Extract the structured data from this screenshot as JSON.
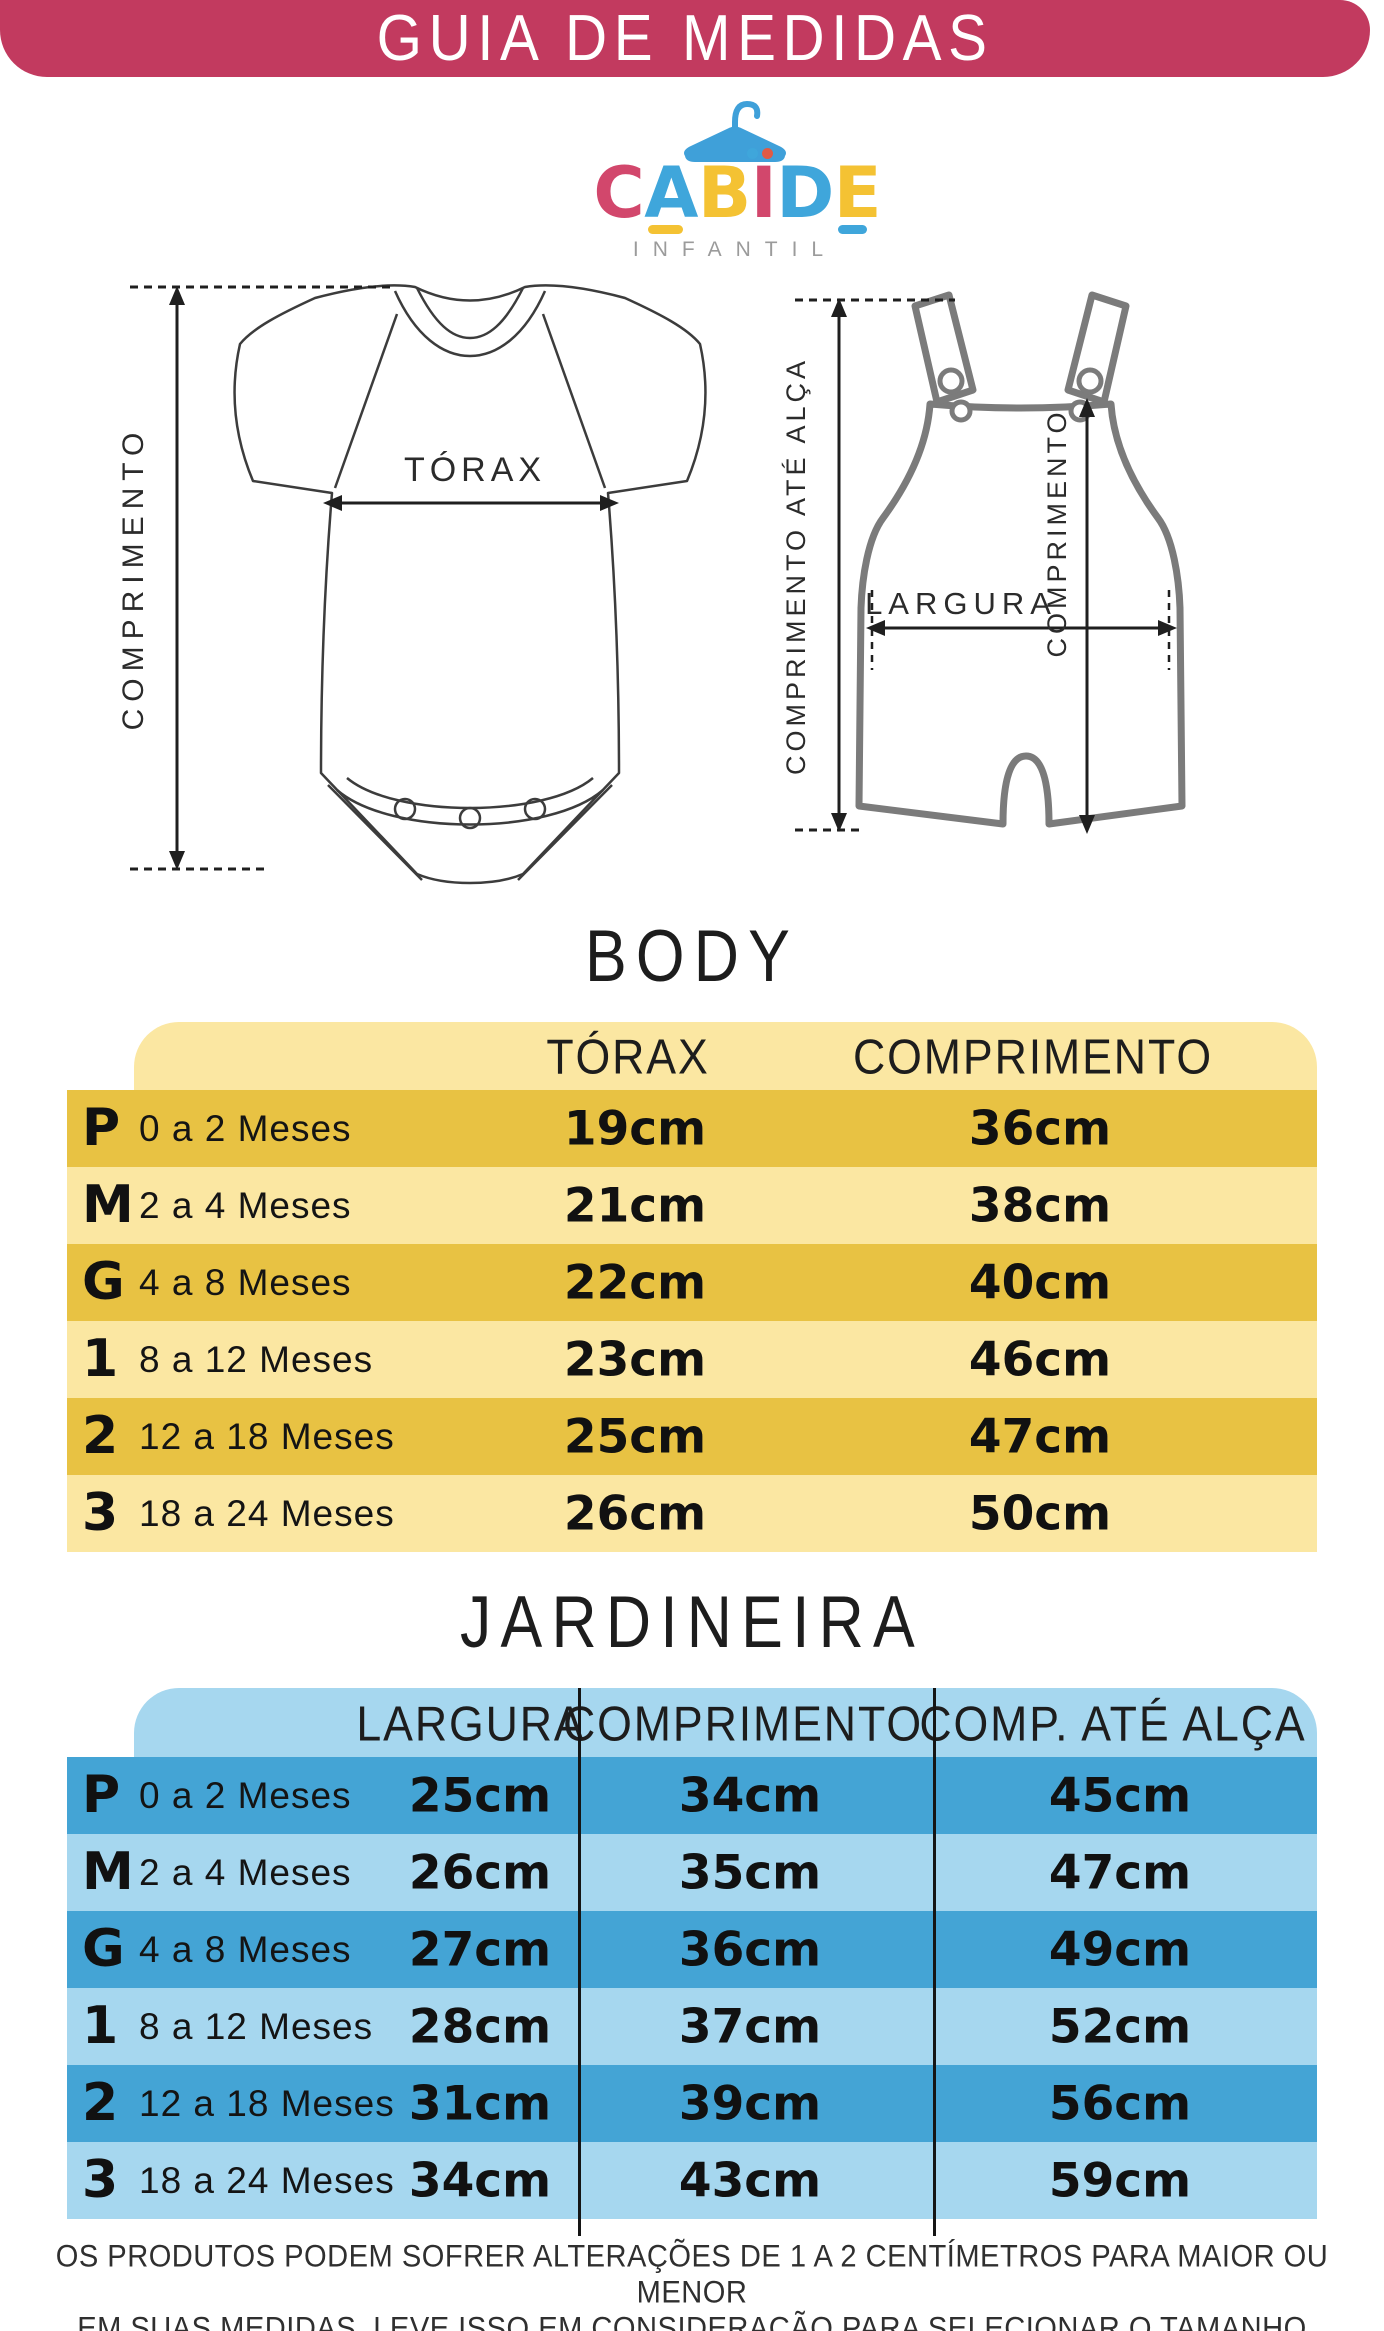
{
  "header": {
    "title": "GUIA DE MEDIDAS",
    "bg_color": "#C23A5F"
  },
  "logo": {
    "letters": [
      {
        "ch": "C",
        "color": "#D2476C"
      },
      {
        "ch": "A",
        "color": "#3FA6DB",
        "underline": "#F4C233"
      },
      {
        "ch": "B",
        "color": "#F4C233"
      },
      {
        "ch": "I",
        "color": "#D2476C",
        "dot_left": "#3FA6DB",
        "dot_right": "#E05A45"
      },
      {
        "ch": "D",
        "color": "#3FA6DB"
      },
      {
        "ch": "E",
        "color": "#F4C233",
        "underline": "#3FA6DB"
      }
    ],
    "subtitle": "INFANTIL",
    "hanger_color": "#3FA0D9"
  },
  "diagrams": {
    "body": {
      "labels": {
        "length": "COMPRIMENTO",
        "chest": "TÓRAX"
      }
    },
    "jardineira": {
      "labels": {
        "strap": "COMPRIMENTO ATÉ ALÇA",
        "length": "COMPRIMENTO",
        "width": "LARGURA"
      }
    }
  },
  "body_table": {
    "title": "BODY",
    "columns": [
      "TÓRAX",
      "COMPRIMENTO"
    ],
    "colors": {
      "header_bg": "#FBE7A2",
      "row_dark": "#E8C243",
      "row_light": "#FBE7A2"
    },
    "rows": [
      {
        "size": "P",
        "age": "0 a 2 Meses",
        "torax": "19cm",
        "comprimento": "36cm"
      },
      {
        "size": "M",
        "age": "2 a 4 Meses",
        "torax": "21cm",
        "comprimento": "38cm"
      },
      {
        "size": "G",
        "age": "4 a 8 Meses",
        "torax": "22cm",
        "comprimento": "40cm"
      },
      {
        "size": "1",
        "age": "8 a 12 Meses",
        "torax": "23cm",
        "comprimento": "46cm"
      },
      {
        "size": "2",
        "age": "12 a 18 Meses",
        "torax": "25cm",
        "comprimento": "47cm"
      },
      {
        "size": "3",
        "age": "18 a 24 Meses",
        "torax": "26cm",
        "comprimento": "50cm"
      }
    ]
  },
  "jardineira_table": {
    "title": "JARDINEIRA",
    "columns": [
      "LARGURA",
      "COMPRIMENTO",
      "COMP. ATÉ ALÇA"
    ],
    "colors": {
      "header_bg": "#A6D7EF",
      "row_dark": "#44A4D5",
      "row_light": "#A6D7EF"
    },
    "rows": [
      {
        "size": "P",
        "age": "0 a 2 Meses",
        "largura": "25cm",
        "comprimento": "34cm",
        "comp_ate_alca": "45cm"
      },
      {
        "size": "M",
        "age": "2 a 4 Meses",
        "largura": "26cm",
        "comprimento": "35cm",
        "comp_ate_alca": "47cm"
      },
      {
        "size": "G",
        "age": "4 a 8 Meses",
        "largura": "27cm",
        "comprimento": "36cm",
        "comp_ate_alca": "49cm"
      },
      {
        "size": "1",
        "age": "8 a 12 Meses",
        "largura": "28cm",
        "comprimento": "37cm",
        "comp_ate_alca": "52cm"
      },
      {
        "size": "2",
        "age": "12 a 18 Meses",
        "largura": "31cm",
        "comprimento": "39cm",
        "comp_ate_alca": "56cm"
      },
      {
        "size": "3",
        "age": "18 a 24 Meses",
        "largura": "34cm",
        "comprimento": "43cm",
        "comp_ate_alca": "59cm"
      }
    ]
  },
  "footer": {
    "line1": "OS PRODUTOS PODEM SOFRER ALTERAÇÕES DE 1 A 2 CENTÍMETROS PARA MAIOR OU MENOR",
    "line2": "EM SUAS MEDIDAS, LEVE ISSO EM CONSIDERAÇÃO PARA SELECIONAR O TAMANHO ADEQUADO."
  }
}
